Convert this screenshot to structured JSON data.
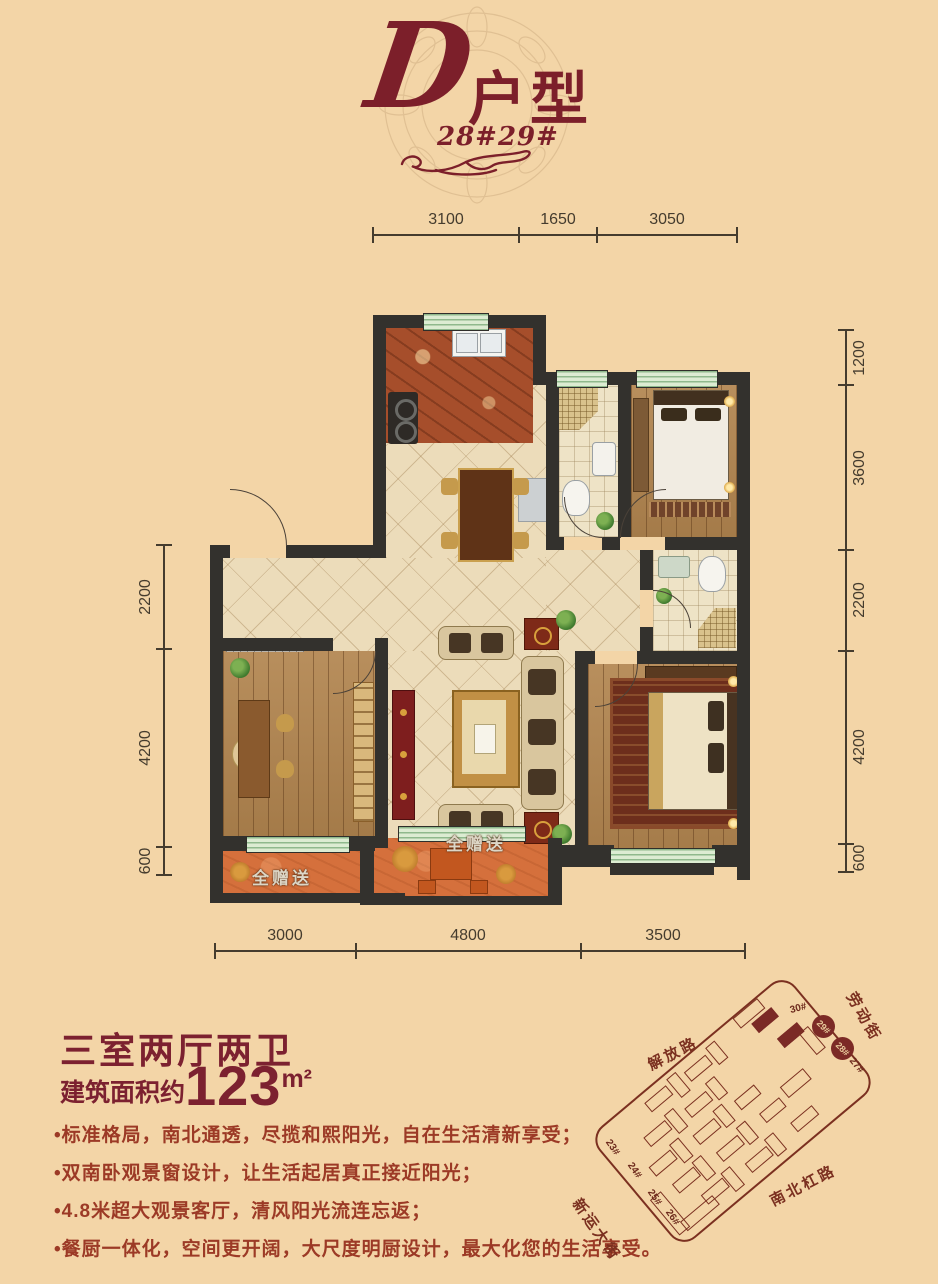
{
  "header": {
    "type_letter": "D",
    "type_suffix": "户型",
    "building_numbers": "28#29#"
  },
  "plan": {
    "gift_label_left": "全赠送",
    "gift_label_center": "全赠送",
    "dimensions": {
      "top": [
        "3100",
        "1650",
        "3050"
      ],
      "bottom": [
        "3000",
        "4800",
        "3500"
      ],
      "right": [
        "1200",
        "3600",
        "2200",
        "4200",
        "600"
      ],
      "left": [
        "2200",
        "4200",
        "600"
      ]
    }
  },
  "info": {
    "headline": "三室两厅两卫",
    "area_prefix": "建筑面积约",
    "area_value": "123",
    "area_unit": "m²",
    "features": [
      "•标准格局，南北通透，尽揽和熙阳光，自在生活清新享受；",
      "•双南卧观景窗设计，让生活起居真正接近阳光；",
      "•4.8米超大观景客厅，清风阳光流连忘返；",
      "•餐厨一体化，空间更开阔，大尺度明厨设计，最大化您的生活享受。"
    ]
  },
  "site_map": {
    "streets": {
      "top_right": "劳动街",
      "top_left": "解放路",
      "bottom_right": "南北杠路",
      "bottom_left": "新运大街"
    },
    "building_labels": {
      "b30": "30#",
      "b29": "29#",
      "b28": "28#",
      "b27": "27#",
      "b23": "23#",
      "b24": "24#",
      "b25": "25#",
      "b26": "26#"
    }
  },
  "colors": {
    "background": "#f3d5a7",
    "title_maroon": "#7c1f2a",
    "feature_text": "#9c3a26",
    "wall": "#33312d",
    "dimension": "#453c2e",
    "window_green": "#dcecd2",
    "wood_floor": "#b2854f",
    "tile_floor": "#ecdcba",
    "kitchen_floor": "#a64e2b",
    "balcony_floor": "#d5703c",
    "map_stroke": "#7b3020"
  }
}
